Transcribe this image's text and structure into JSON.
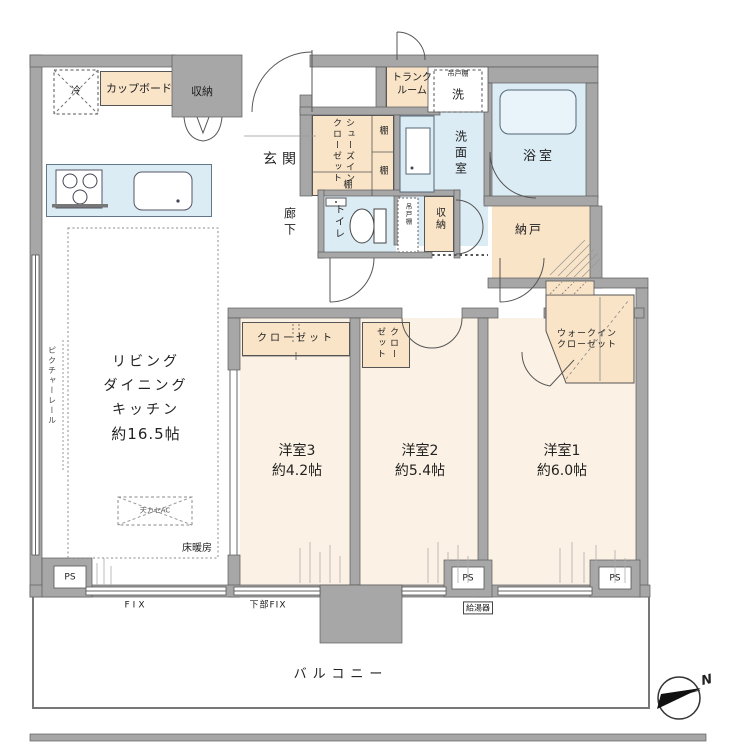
{
  "colors": {
    "wall": "#a7a7a7",
    "peach": "#f9e4c8",
    "cream": "#fbf1e4",
    "water": "#dcecf5"
  },
  "kitchen": {
    "fridge": "冷",
    "cupboard": "カップボード",
    "storage": "収納"
  },
  "entry": {
    "genkan": "玄関",
    "trunk": "トランクルーム"
  },
  "sic": {
    "label": "シューズインクローゼット",
    "shelf_bottom": "棚",
    "shelf1": "棚",
    "shelf2": "棚"
  },
  "sanitary": {
    "washer": "洗",
    "hanging1": "吊戸棚",
    "washroom": "洗面室",
    "bath": "浴室",
    "toilet": "トイレ",
    "hanging2": "吊戸棚",
    "storage": "収納"
  },
  "corridor": {
    "label": "廊下"
  },
  "nando": {
    "label": "納戸"
  },
  "ldk": {
    "l1": "リビング",
    "l2": "ダイニング",
    "l3": "キッチン",
    "size": "約16.5帖",
    "heating": "床暖房",
    "ac": "天カセAC",
    "rail": "ピクチャーレール"
  },
  "rooms": {
    "b3": {
      "name": "洋室3",
      "size": "約4.2帖",
      "closet": "クローゼット"
    },
    "b2": {
      "name": "洋室2",
      "size": "約5.4帖",
      "closet": "クローゼット"
    },
    "b1": {
      "name": "洋室1",
      "size": "約6.0帖",
      "wic1": "ウォークイン",
      "wic2": "クローゼット"
    }
  },
  "bottom": {
    "ps_left": "PS",
    "ps_mid": "PS",
    "ps_right": "PS",
    "fix": "FIX",
    "lower_fix": "下部FIX",
    "boiler": "給湯器"
  },
  "balcony": {
    "label": "バルコニー"
  },
  "compass": {
    "north": "N"
  }
}
